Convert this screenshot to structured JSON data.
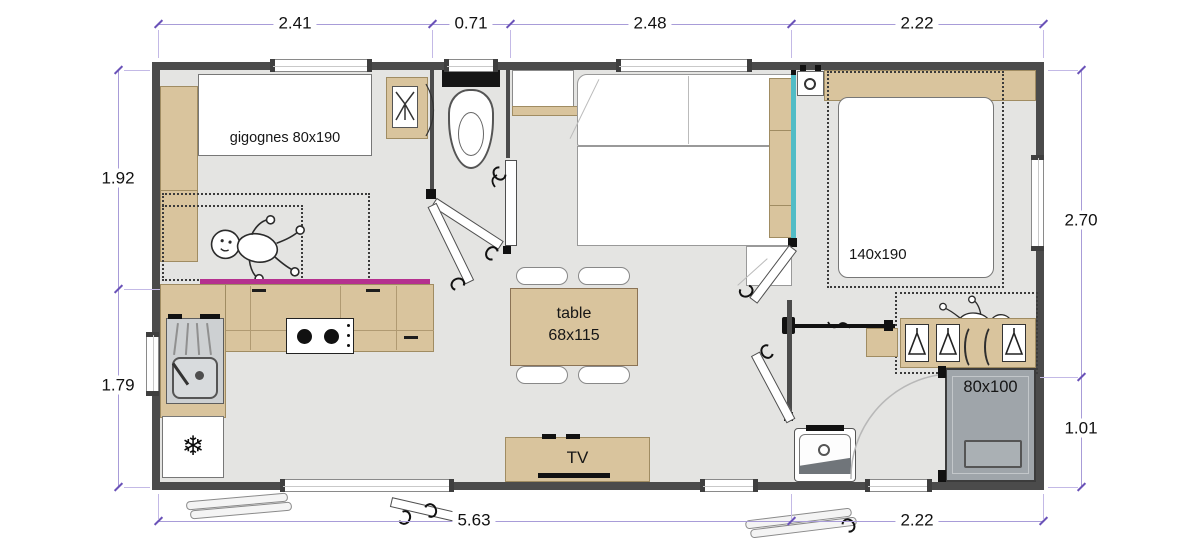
{
  "plan": {
    "labels": {
      "kids_bed": "gigognes 80x190",
      "master_bed": "140x190",
      "table_line1": "table",
      "table_line2": "68x115",
      "tv": "TV",
      "shower": "80x100"
    },
    "dimensions": {
      "top": [
        "2.41",
        "0.71",
        "2.48",
        "2.22"
      ],
      "left": [
        "1.92",
        "1.79"
      ],
      "right": [
        "2.70",
        "1.01"
      ],
      "bottom": [
        "5.63",
        "2.22"
      ]
    },
    "icons": {
      "fridge_snowflake": "❄"
    },
    "colors": {
      "wall": "#4b4b4b",
      "floor": "#e4e4e2",
      "wood": "#d9c49d",
      "counter_edge_magenta": "#b5308f",
      "partition_teal": "#52bcc6",
      "shower_gray": "#9fa5aa",
      "dimension_purple": "#a89cd8"
    }
  }
}
